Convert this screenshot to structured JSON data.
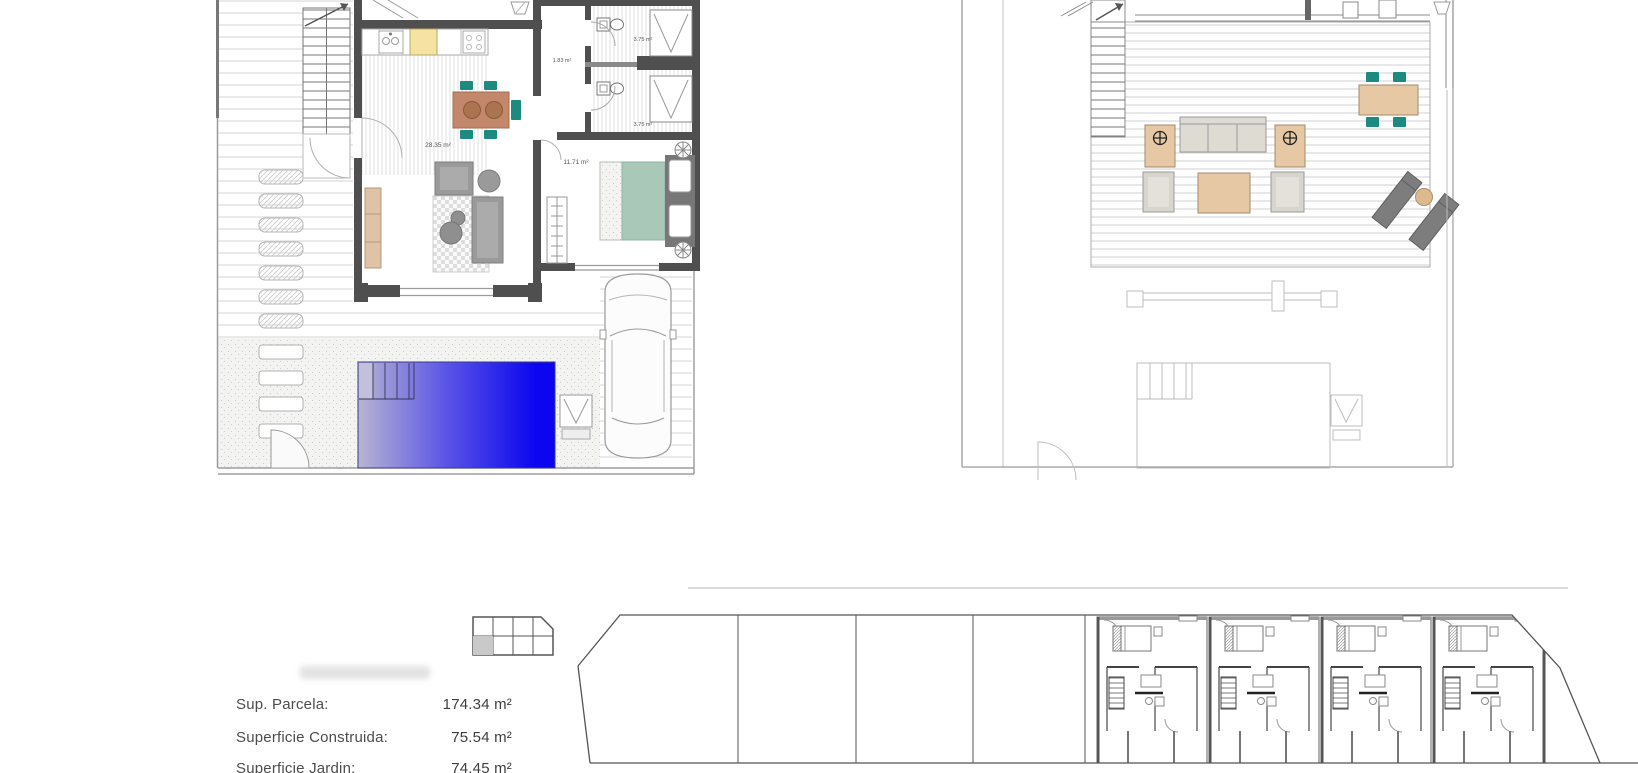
{
  "plans": {
    "ground_floor": {
      "room_labels": {
        "living_dining": "28.35 m²",
        "hallway": "1.83 m²",
        "bathroom_top": "3.75 m²",
        "bathroom_bottom": "3.75 m²",
        "bedroom": "11.71 m²"
      }
    }
  },
  "summary": {
    "rows": [
      {
        "label": "Sup. Parcela:",
        "value": "174.34 m²"
      },
      {
        "label": "Superficie Construida:",
        "value": "75.54 m²"
      },
      {
        "label": "Superficie Jardin:",
        "value": "74.45 m²"
      }
    ]
  },
  "symbols": {
    "umbrella_base_icon": "crosshair-circle",
    "outdoor_shower_icon": "V-in-square",
    "stair_direction_icon": "diagonal-arrow"
  },
  "colors": {
    "pool_start": "#b7b5d2",
    "pool_mid": "#5a54e6",
    "pool_end": "#0b06ef",
    "wall": "#4f4f4f",
    "bed_teal": "#a9c8b8",
    "chair_teal": "#1d8a80",
    "wood_tan": "#e7c8a4",
    "table_brown": "#c3876b",
    "counter_yellow": "#f6e3a3",
    "sofa_gray": "#9a9a9a",
    "lounger_gray": "#7d7d7d",
    "faint_outline": "#bdbdbd"
  }
}
